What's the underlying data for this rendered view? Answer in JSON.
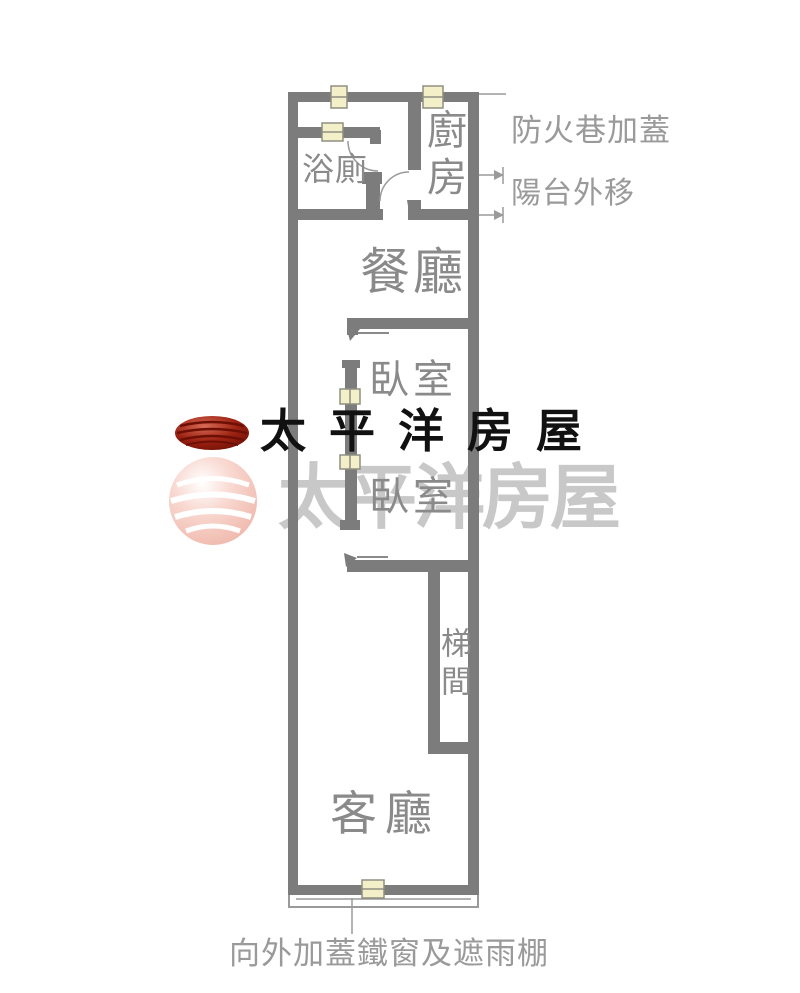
{
  "plan": {
    "rooms": [
      {
        "key": "bathroom",
        "label": "浴廁"
      },
      {
        "key": "kitchen",
        "label": "廚房"
      },
      {
        "key": "dining",
        "label": "餐廳"
      },
      {
        "key": "bedroom-upper",
        "label": "臥室"
      },
      {
        "key": "bedroom-lower",
        "label": "臥室"
      },
      {
        "key": "stairwell",
        "label": "梯間"
      },
      {
        "key": "living",
        "label": "客廳"
      }
    ],
    "annotations": {
      "fire_lane": "防火巷加蓋",
      "balcony": "陽台外移",
      "iron_window": "向外加蓋鐵窗及遮雨棚"
    }
  },
  "watermark": {
    "brand": "太平洋房屋"
  },
  "colors": {
    "wall": "#7c7c7c",
    "room_label": "#8a8a8a",
    "annotation": "#9a9a9a",
    "window_fill": "#f3f0c9",
    "window_line": "#8f8f82",
    "watermark_dark_text": "#111111",
    "watermark_light_text": "#c8c8c8",
    "logo_red_dark": "#701005",
    "logo_red": "#9c2212",
    "logo_pink": "#f1bdb2"
  }
}
